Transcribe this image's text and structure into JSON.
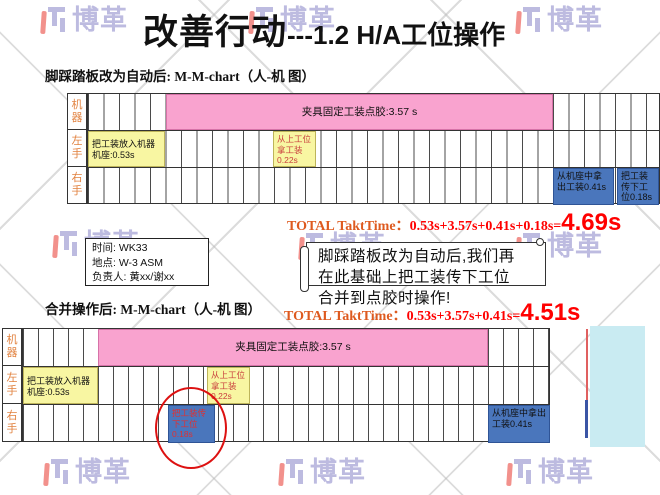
{
  "watermark": {
    "text": "博革"
  },
  "title": {
    "main": "改善行动",
    "suffix": "---1.2 H/A工位操作"
  },
  "sections": [
    {
      "heading": "脚踩踏板改为自动后: M-M-chart（人-机 图）",
      "total": {
        "label": "TOTAL TaktTime：",
        "formula": "0.53s+3.57s+0.41s+0.18s=",
        "value": "4.69s"
      }
    },
    {
      "heading": "合并操作后: M-M-chart（人-机 图）",
      "total": {
        "label": "TOTAL TaktTime：",
        "formula": "0.53s+3.57s+0.41s=",
        "value": "4.51s"
      }
    }
  ],
  "charts": [
    {
      "row_labels": [
        "机器",
        "左手",
        "右手"
      ],
      "machine_bar": "夹具固定工装点胶:3.57 s",
      "place_fixture": "把工装放入机器机座:0.53s",
      "take_from_upstream": "从上工位拿工装0.22s",
      "take_out_fixture": "从机座中拿出工装0.41s",
      "pass_down_fixture": "把工装传下工位0.18s"
    },
    {
      "row_labels": [
        "机器",
        "左手",
        "右手"
      ],
      "machine_bar": "夹具固定工装点胶:3.57 s",
      "place_fixture": "把工装放入机器机座:0.53s",
      "take_from_upstream": "从上工位拿工装0.22s",
      "take_out_fixture": "从机座中拿出工装0.41s",
      "pass_down_fixture": "把工装传下工位0.18s"
    }
  ],
  "info_box": {
    "time": "时间: WK33",
    "place": "地点: W-3 ASM",
    "owner": "负责人: 黄xx/谢xx"
  },
  "callout": {
    "line1": "脚踩踏板改为自动后,我们再",
    "line2": "在此基础上把工装传下工位",
    "line3": "合并到点胶时操作!"
  },
  "colors": {
    "pink": "#F9A3CF",
    "yellow": "#F8F6A2",
    "blue": "#4A76BC",
    "cyan": "#C9EBF2",
    "label_orange": "#E2823F",
    "total_orange": "#DE5A1F",
    "red": "#FF0000",
    "watermark_purple": "#BDBBE0",
    "watermark_red": "#F2918C"
  }
}
